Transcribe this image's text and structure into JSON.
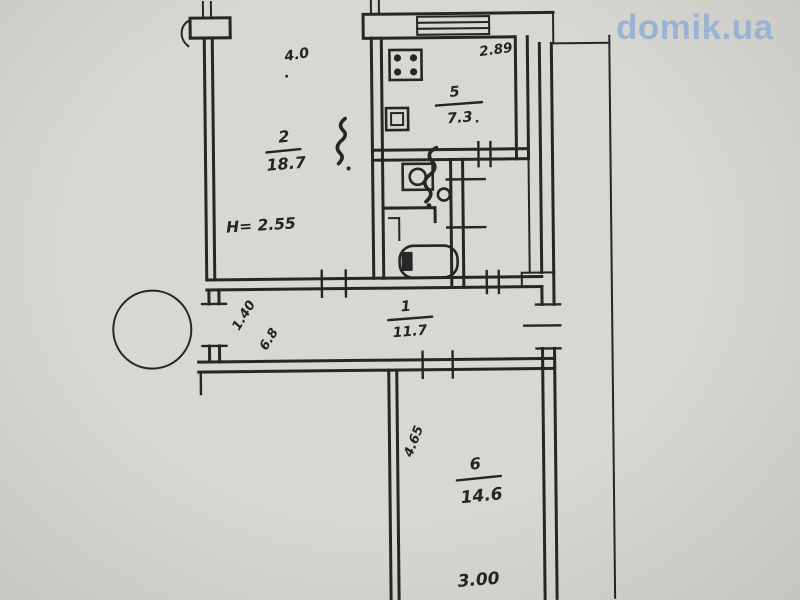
{
  "watermark": {
    "text": "domik.ua"
  },
  "theme": {
    "paper": "#d8d7d2",
    "paper_edge": "#c6c5c0",
    "ink": "#262626",
    "logo_color": "#9ab3d2"
  },
  "floorplan": {
    "type": "apartment-floor-plan-scan",
    "rooms": {
      "living": {
        "number": "2",
        "area": "18.7"
      },
      "kitchen": {
        "number": "5",
        "area": "7.3"
      },
      "hall": {
        "number": "1",
        "area": "11.7"
      },
      "room6": {
        "number": "6",
        "area": "14.6"
      }
    },
    "notes": {
      "ceiling_height": "H= 2.55"
    },
    "dims": {
      "living_top": "4.0",
      "kitchen_top": "2.89",
      "hall_door": "1.40",
      "hall_width": "6.8",
      "room6_side": "4.65",
      "room6_bottom": "3.00"
    },
    "fixtures": [
      "stove-icon",
      "sink-icon",
      "toilet-icon",
      "washbasin-icon",
      "bathtub-icon",
      "column-icon",
      "window-icon"
    ]
  }
}
